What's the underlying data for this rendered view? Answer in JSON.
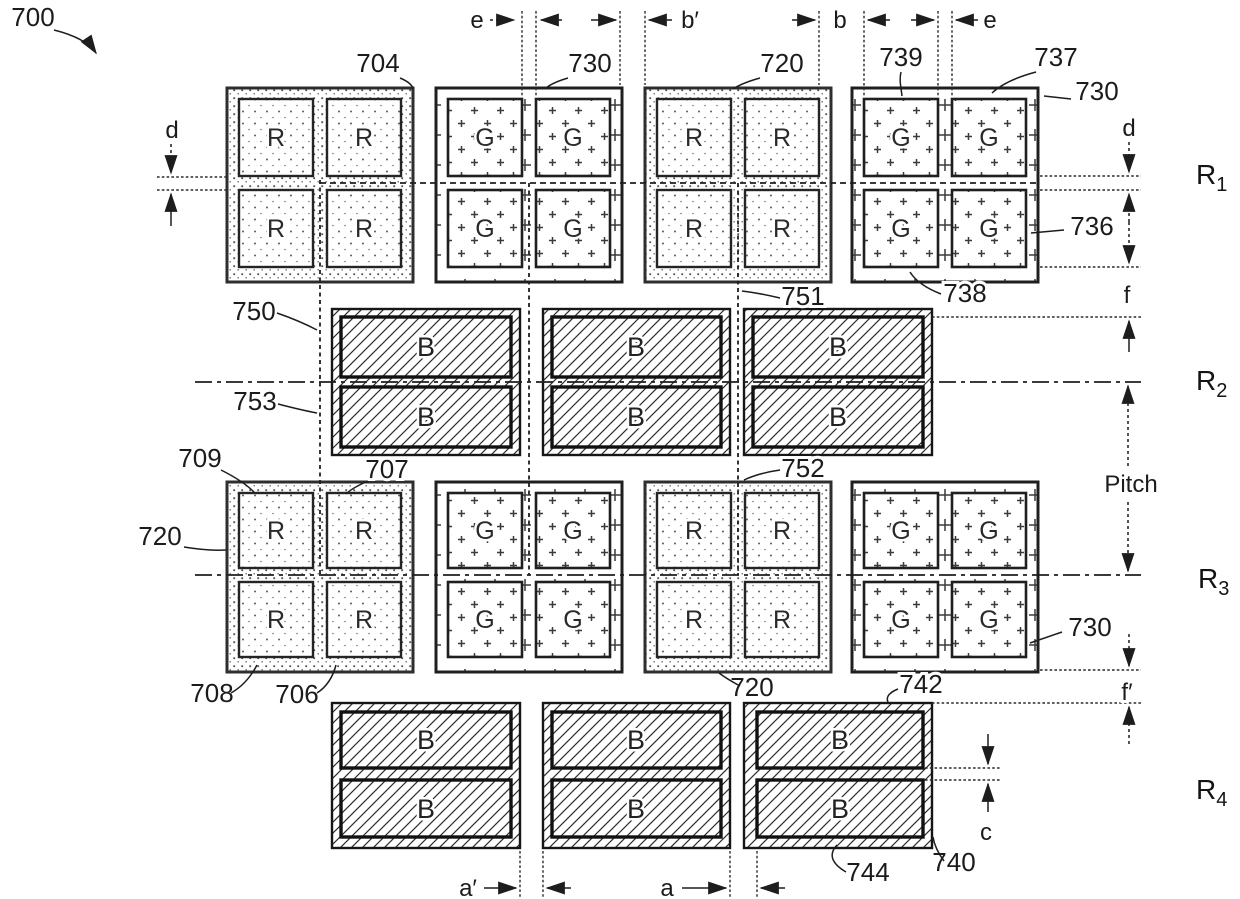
{
  "figure": {
    "reference": "700",
    "row_labels": [
      {
        "base": "R",
        "sub": "1"
      },
      {
        "base": "R",
        "sub": "2"
      },
      {
        "base": "R",
        "sub": "3"
      },
      {
        "base": "R",
        "sub": "4"
      }
    ],
    "rows": [
      {
        "type": "quad-subpixel-row",
        "groups": [
          "R",
          "G",
          "R",
          "G"
        ]
      },
      {
        "type": "pair-subpixel-row",
        "groups": [
          "B",
          "B",
          "B"
        ]
      },
      {
        "type": "quad-subpixel-row",
        "groups": [
          "R",
          "G",
          "R",
          "G"
        ]
      },
      {
        "type": "pair-subpixel-row",
        "groups": [
          "B",
          "B",
          "B"
        ]
      }
    ],
    "refs": {
      "r700": "700",
      "r704": "704",
      "r706": "706",
      "r707": "707",
      "r708": "708",
      "r709": "709",
      "r720": "720",
      "r730": "730",
      "r736": "736",
      "r737": "737",
      "r738": "738",
      "r739": "739",
      "r740": "740",
      "r742": "742",
      "r744": "744",
      "r750": "750",
      "r751": "751",
      "r752": "752",
      "r753": "753"
    },
    "dims": {
      "a": "a",
      "a_prime": "a′",
      "b": "b",
      "b_prime": "b′",
      "c": "c",
      "d": "d",
      "e": "e",
      "f": "f",
      "f_prime": "f′",
      "pitch": "Pitch"
    },
    "colors": {
      "ink": "#1d1d1d",
      "paper": "#ffffff",
      "stipple": "#595959"
    }
  }
}
